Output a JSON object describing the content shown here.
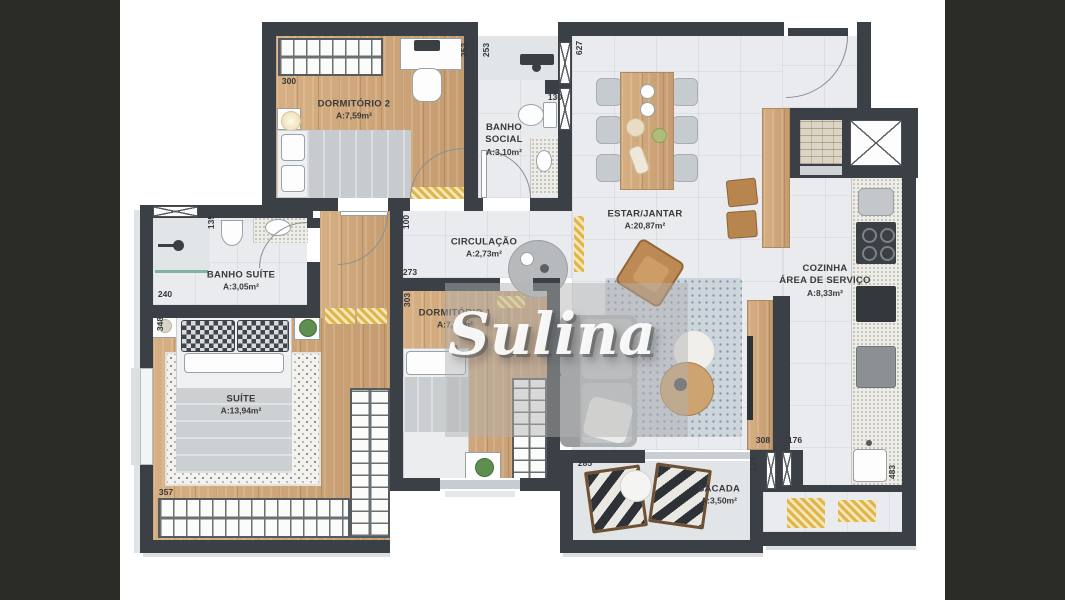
{
  "watermark": {
    "text": "Sulina"
  },
  "rooms": {
    "dormitorio2": {
      "name": "DORMITÓRIO 2",
      "area": "A:7,59m²"
    },
    "banho_social": {
      "line1": "BANHO",
      "line2": "SOCIAL",
      "area": "A:3,10m²"
    },
    "estar_jantar": {
      "name": "ESTAR/JANTAR",
      "area": "A:20,87m²"
    },
    "cozinha": {
      "line1": "COZINHA",
      "line2": "ÁREA DE SERVIÇO",
      "area": "A:8,33m²"
    },
    "banho_suite": {
      "name": "BANHO SUÍTE",
      "area": "A:3,05m²"
    },
    "circulacao": {
      "name": "CIRCULAÇÃO",
      "area": "A:2,73m²"
    },
    "dormitorio1": {
      "name": "DORMITÓRIO 1",
      "area": "A:7,70m²"
    },
    "suite": {
      "name": "SUÍTE",
      "area": "A:13,94m²"
    },
    "sacada": {
      "name": "SACADA",
      "area": "A:3,50m²"
    }
  },
  "dimensions": {
    "d300": "300",
    "d253a": "253",
    "d253b": "253",
    "d627": "627",
    "d130": "130",
    "d135": "135",
    "d240": "240",
    "d348": "348",
    "d100": "100",
    "d273": "273",
    "d303": "303",
    "d256": "256",
    "d357": "357",
    "d285": "285",
    "d308": "308",
    "d176": "176",
    "d123": "123",
    "d483": "483"
  },
  "colors": {
    "wall": "#3a4045",
    "background_side": "#2b2b27",
    "canvas": "#ffffff",
    "wood_floor": "#cfa87d",
    "tile_floor": "#e9ebee",
    "accent_yellow": "#e0b54c"
  }
}
